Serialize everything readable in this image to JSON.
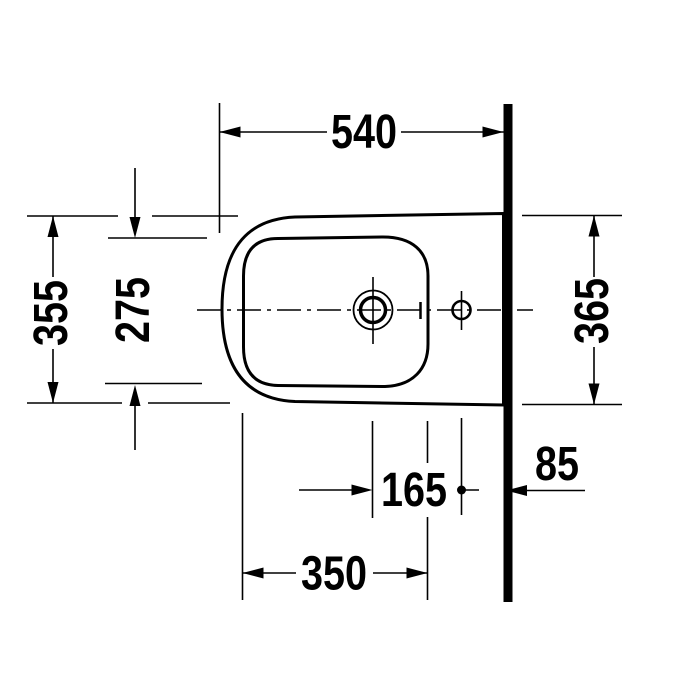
{
  "drawing": {
    "title": "Bidet top view dimension drawing",
    "view": "plan (top) view, wall-mounted bidet against wall on right",
    "units": "mm",
    "dims": {
      "total_width": "540",
      "outer_depth_front": "355",
      "bowl_inner_depth": "275",
      "outer_depth_at_wall": "365",
      "drain_to_tap_hole": "165",
      "tap_hole_to_wall": "85",
      "bowl_inner_length": "350"
    },
    "features": {
      "wall": "thick solid wall line on right side",
      "body": "outer ceramic body outline with large rounded front corners",
      "bowl": "inner bowl rim outline, rounded rectangle",
      "drain": "concentric drain circles on centerline",
      "tap_hole": "small tap hole circle near wall on centerline",
      "centerline": "horizontal dash-dot centerline"
    },
    "colors": {
      "line": "#000000",
      "wall_fill": "#000000",
      "background": "#ffffff"
    }
  }
}
